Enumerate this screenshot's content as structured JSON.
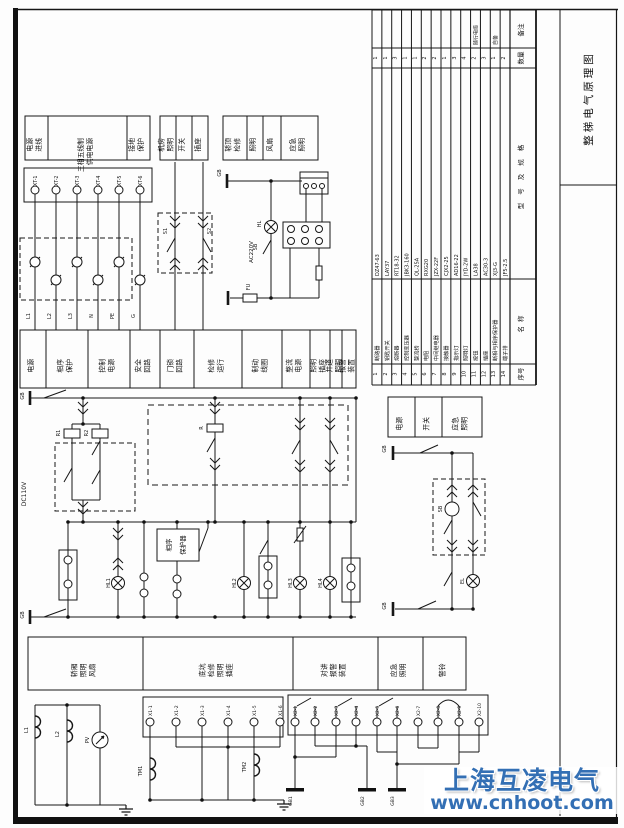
{
  "title_block": {
    "title": "整梯电气原理图"
  },
  "watermark": {
    "name": "上海互凌电气",
    "url": "www.cnhoot.com",
    "color": "#336fb4"
  },
  "panels": {
    "group_a": [
      "电源 进线",
      "三相五线制 供电电源",
      "接地 保护"
    ],
    "group_b": [
      "机房 照明",
      "开关",
      "插座"
    ],
    "group_c": [
      "轿顶 检修",
      "照明",
      "风扇",
      "应急 照明"
    ],
    "mid_band": [
      "电源",
      "相序 保护",
      "控制 电源",
      "安全 回路",
      "门锁 回路",
      "检修 运行",
      "制动 线圈",
      "整流 电源",
      "照明 插座",
      "井道 照明",
      "报警 装置"
    ],
    "bottom_band": [
      "轿厢 照明 风扇",
      "底坑 检修 照明 插座",
      "对讲 报警 装置",
      "应急 照明",
      "警铃"
    ],
    "right_box": [
      "电源",
      "开关",
      "应急 照明"
    ]
  },
  "bom": {
    "row_headers": [
      "备注",
      "数量",
      "型号及规格",
      "名称",
      "序号"
    ],
    "items": [
      {
        "seq": "1",
        "code": "QF",
        "name": "断路器",
        "spec": "DZ47-63",
        "qty": "1",
        "remark": ""
      },
      {
        "seq": "2",
        "code": "SA",
        "name": "钥匙开关",
        "spec": "LAY37",
        "qty": "1",
        "remark": ""
      },
      {
        "seq": "3",
        "code": "FU",
        "name": "熔断器",
        "spec": "RT18-32",
        "qty": "3",
        "remark": ""
      },
      {
        "seq": "4",
        "code": "T",
        "name": "控制变压器",
        "spec": "JBK3-160",
        "qty": "1",
        "remark": ""
      },
      {
        "seq": "5",
        "code": "VC",
        "name": "整流桥",
        "spec": "QL-25A",
        "qty": "1",
        "remark": ""
      },
      {
        "seq": "6",
        "code": "R",
        "name": "电阻",
        "spec": "RXG20",
        "qty": "2",
        "remark": ""
      },
      {
        "seq": "7",
        "code": "KA",
        "name": "中间继电器",
        "spec": "JZX-22F",
        "qty": "2",
        "remark": ""
      },
      {
        "seq": "8",
        "code": "KM",
        "name": "接触器",
        "spec": "CJX2-25",
        "qty": "1",
        "remark": ""
      },
      {
        "seq": "9",
        "code": "HL",
        "name": "指示灯",
        "spec": "AD16-22",
        "qty": "3",
        "remark": ""
      },
      {
        "seq": "10",
        "code": "EL",
        "name": "照明灯",
        "spec": "JYD-2W",
        "qty": "4",
        "remark": ""
      },
      {
        "seq": "11",
        "code": "SB",
        "name": "按钮",
        "spec": "LA38",
        "qty": "2",
        "remark": "随行电缆"
      },
      {
        "seq": "12",
        "code": "XS",
        "name": "插座",
        "spec": "AC30-3",
        "qty": "3",
        "remark": ""
      },
      {
        "seq": "13",
        "code": "KP",
        "name": "断相与相序保护器",
        "spec": "XJ3-G",
        "qty": "1",
        "remark": "自备"
      },
      {
        "seq": "14",
        "code": "XT",
        "name": "端子排",
        "spec": "JF5-2.5",
        "qty": "2",
        "remark": ""
      }
    ]
  },
  "schematic_labels": [
    "XT-1",
    "XT-2",
    "XT-3",
    "XT-4",
    "XT-5",
    "XT-6",
    "L1",
    "L2",
    "L3",
    "N",
    "PE",
    "G",
    "AC220V",
    "DC110V",
    "GB",
    "FU",
    "HL",
    "SB",
    "R1",
    "R2",
    "R",
    "S1",
    "S2",
    "相序",
    "保护器",
    "HL1",
    "HL2",
    "HL3",
    "HL4",
    "EL",
    "SB",
    "GB",
    "GB",
    "GB",
    "GB",
    "PV",
    "L1",
    "L2",
    "TM1",
    "TM2",
    "X1-1",
    "X1-2",
    "X1-3",
    "X1-4",
    "X1-5",
    "X1-6",
    "X2-1",
    "X2-2",
    "X2-3",
    "X2-4",
    "X2-5",
    "X2-6",
    "X2-7",
    "X2-8",
    "X2-9",
    "X2-10",
    "GB1",
    "GB2",
    "GB3"
  ]
}
